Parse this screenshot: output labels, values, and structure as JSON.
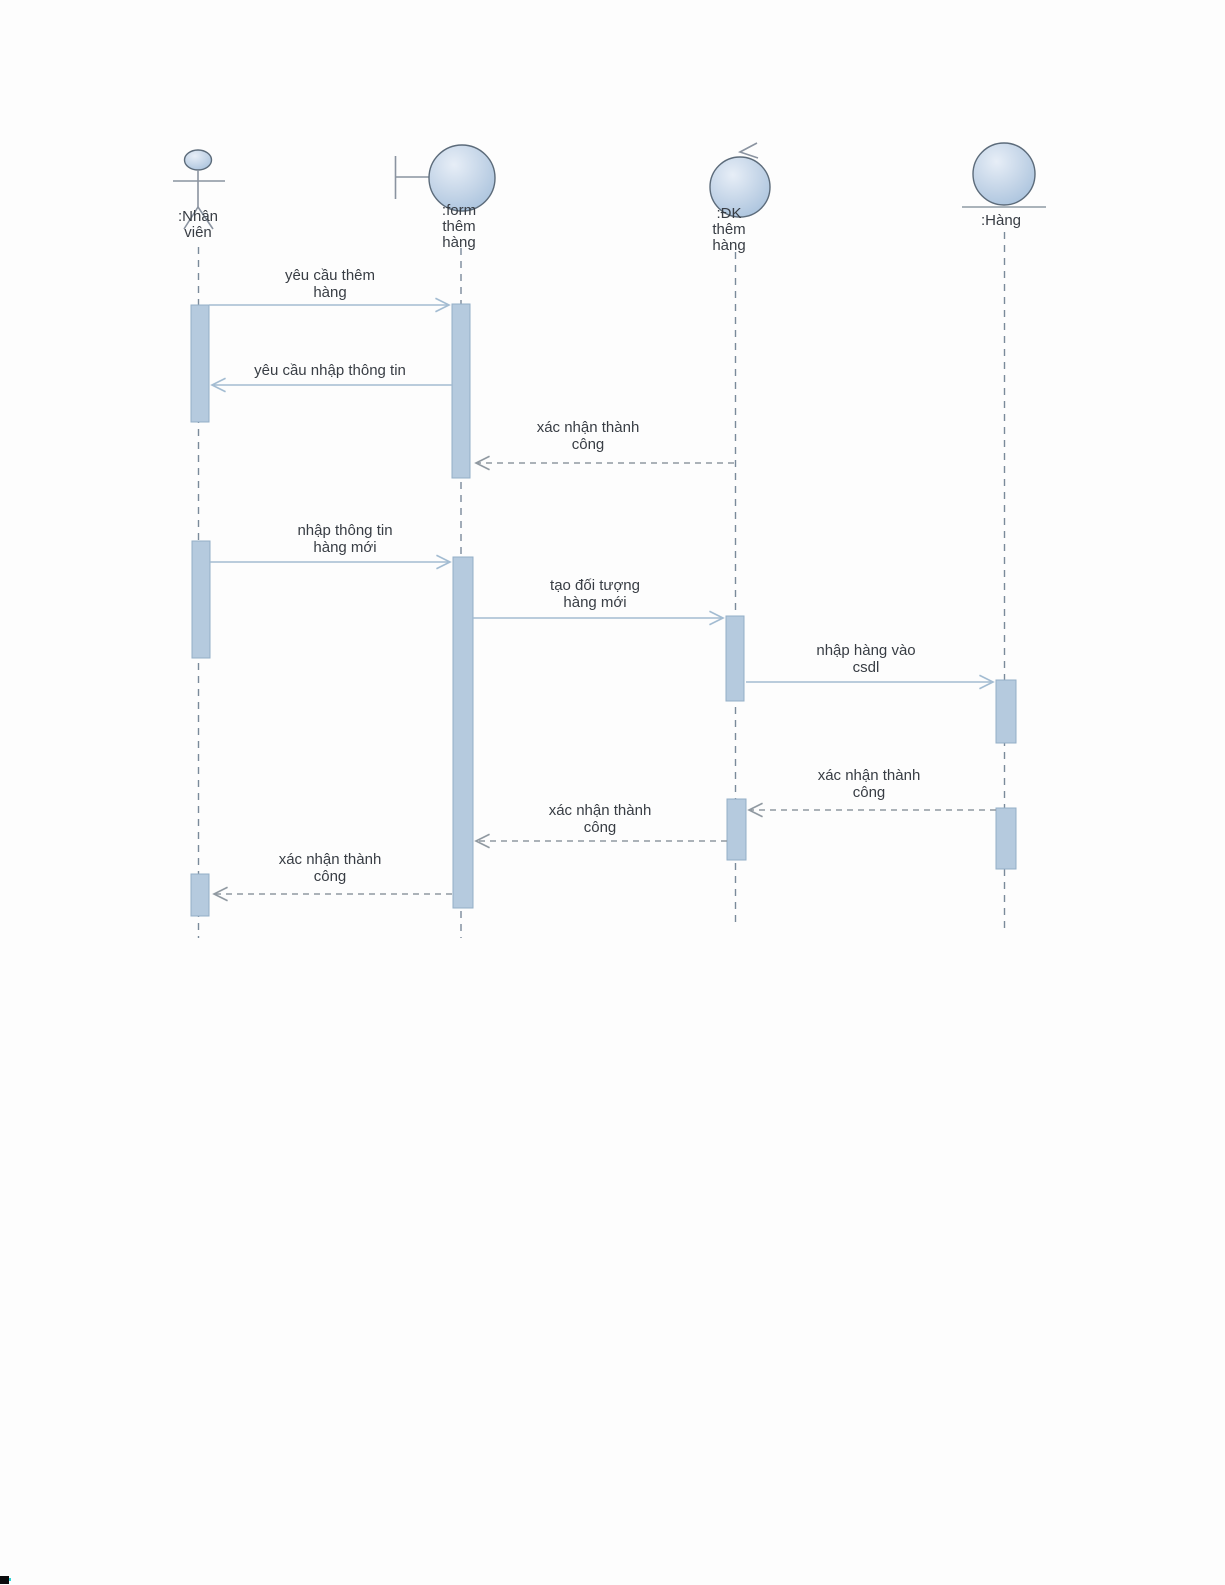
{
  "diagram_type": "uml-sequence",
  "colors": {
    "background": "#fdfdfd",
    "text": "#383d44",
    "lifeline": "#7a8a9a",
    "arrow-solid": "#a3bcd2",
    "arrow-dashed": "#9099a1",
    "activation-fill": "#b5cade",
    "activation-border": "#93aec7",
    "ball-border": "#5c6b7a",
    "icon-stroke": "#8a93a0"
  },
  "lifelines": [
    {
      "id": "nhan-vien",
      "type": "actor",
      "label": ":Nhân\nviên"
    },
    {
      "id": "form-them-hang",
      "type": "boundary",
      "label": ":form\nthêm\nhàng"
    },
    {
      "id": "dk-them-hang",
      "type": "control",
      "label": ":ĐK\nthêm\nhàng"
    },
    {
      "id": "hang",
      "type": "entity",
      "label": ":Hàng"
    }
  ],
  "messages": [
    {
      "from": "nhan-vien",
      "to": "form-them-hang",
      "style": "solid",
      "label": "yêu cầu thêm\nhàng"
    },
    {
      "from": "form-them-hang",
      "to": "nhan-vien",
      "style": "solid",
      "label": "yêu cầu nhập thông tin"
    },
    {
      "from": "dk-them-hang",
      "to": "form-them-hang",
      "style": "dashed",
      "label": "xác nhận thành\ncông"
    },
    {
      "from": "nhan-vien",
      "to": "form-them-hang",
      "style": "solid",
      "label": "nhập thông tin\nhàng mới"
    },
    {
      "from": "form-them-hang",
      "to": "dk-them-hang",
      "style": "solid",
      "label": "tạo đối tượng\nhàng mới"
    },
    {
      "from": "dk-them-hang",
      "to": "hang",
      "style": "solid",
      "label": "nhập hàng vào\ncsdl"
    },
    {
      "from": "hang",
      "to": "dk-them-hang",
      "style": "dashed",
      "label": "xác nhận thành\ncông"
    },
    {
      "from": "dk-them-hang",
      "to": "form-them-hang",
      "style": "dashed",
      "label": "xác nhận thành\ncông"
    },
    {
      "from": "form-them-hang",
      "to": "nhan-vien",
      "style": "dashed",
      "label": "xác nhận thành\ncông"
    }
  ]
}
